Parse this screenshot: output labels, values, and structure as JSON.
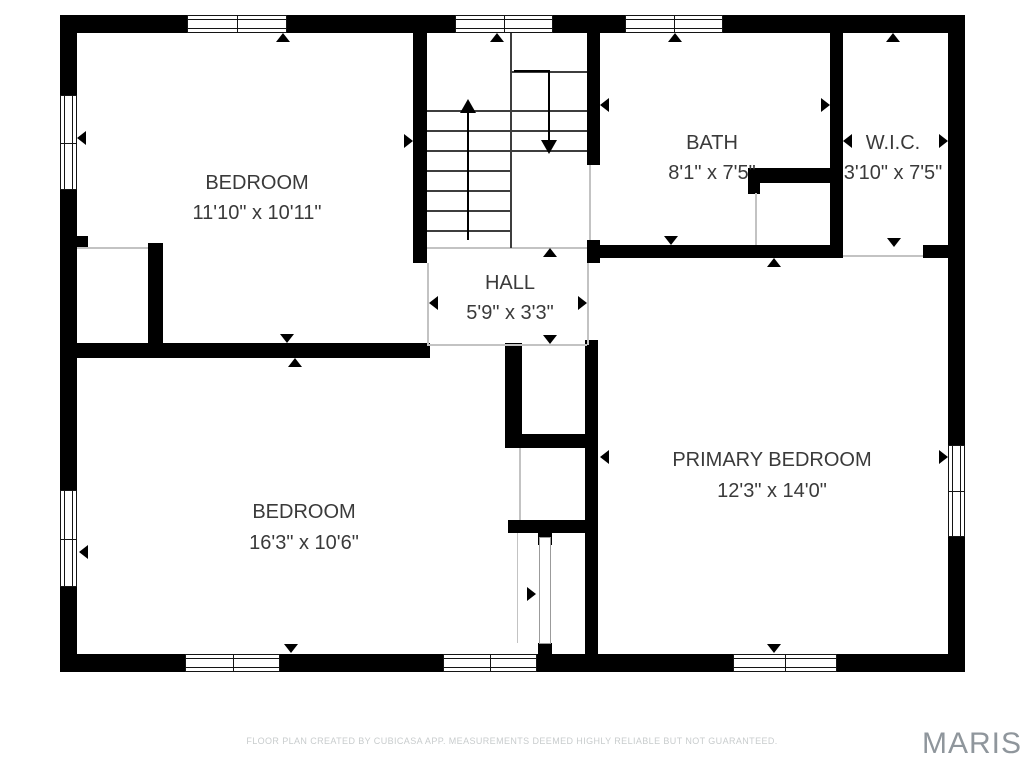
{
  "page": {
    "footer_note": "FLOOR PLAN CREATED BY CUBICASA APP. MEASUREMENTS DEEMED HIGHLY RELIABLE BUT NOT GUARANTEED.",
    "watermark": "MARIS"
  },
  "rooms": [
    {
      "name": "BEDROOM",
      "dims": "11'10\" x 10'11\""
    },
    {
      "name": "BATH",
      "dims": "8'1\" x 7'5\""
    },
    {
      "name": "W.I.C.",
      "dims": "3'10\" x 7'5\""
    },
    {
      "name": "HALL",
      "dims": "5'9\" x 3'3\""
    },
    {
      "name": "BEDROOM",
      "dims": "16'3\" x 10'6\""
    },
    {
      "name": "PRIMARY BEDROOM",
      "dims": "12'3\" x 14'0\""
    }
  ],
  "colors": {
    "wall": "#000000",
    "label_text": "#3a3a3a",
    "footer_text": "#c8cccd",
    "watermark": "#8f969c",
    "open_boundary_line": "#c3c3c3"
  }
}
